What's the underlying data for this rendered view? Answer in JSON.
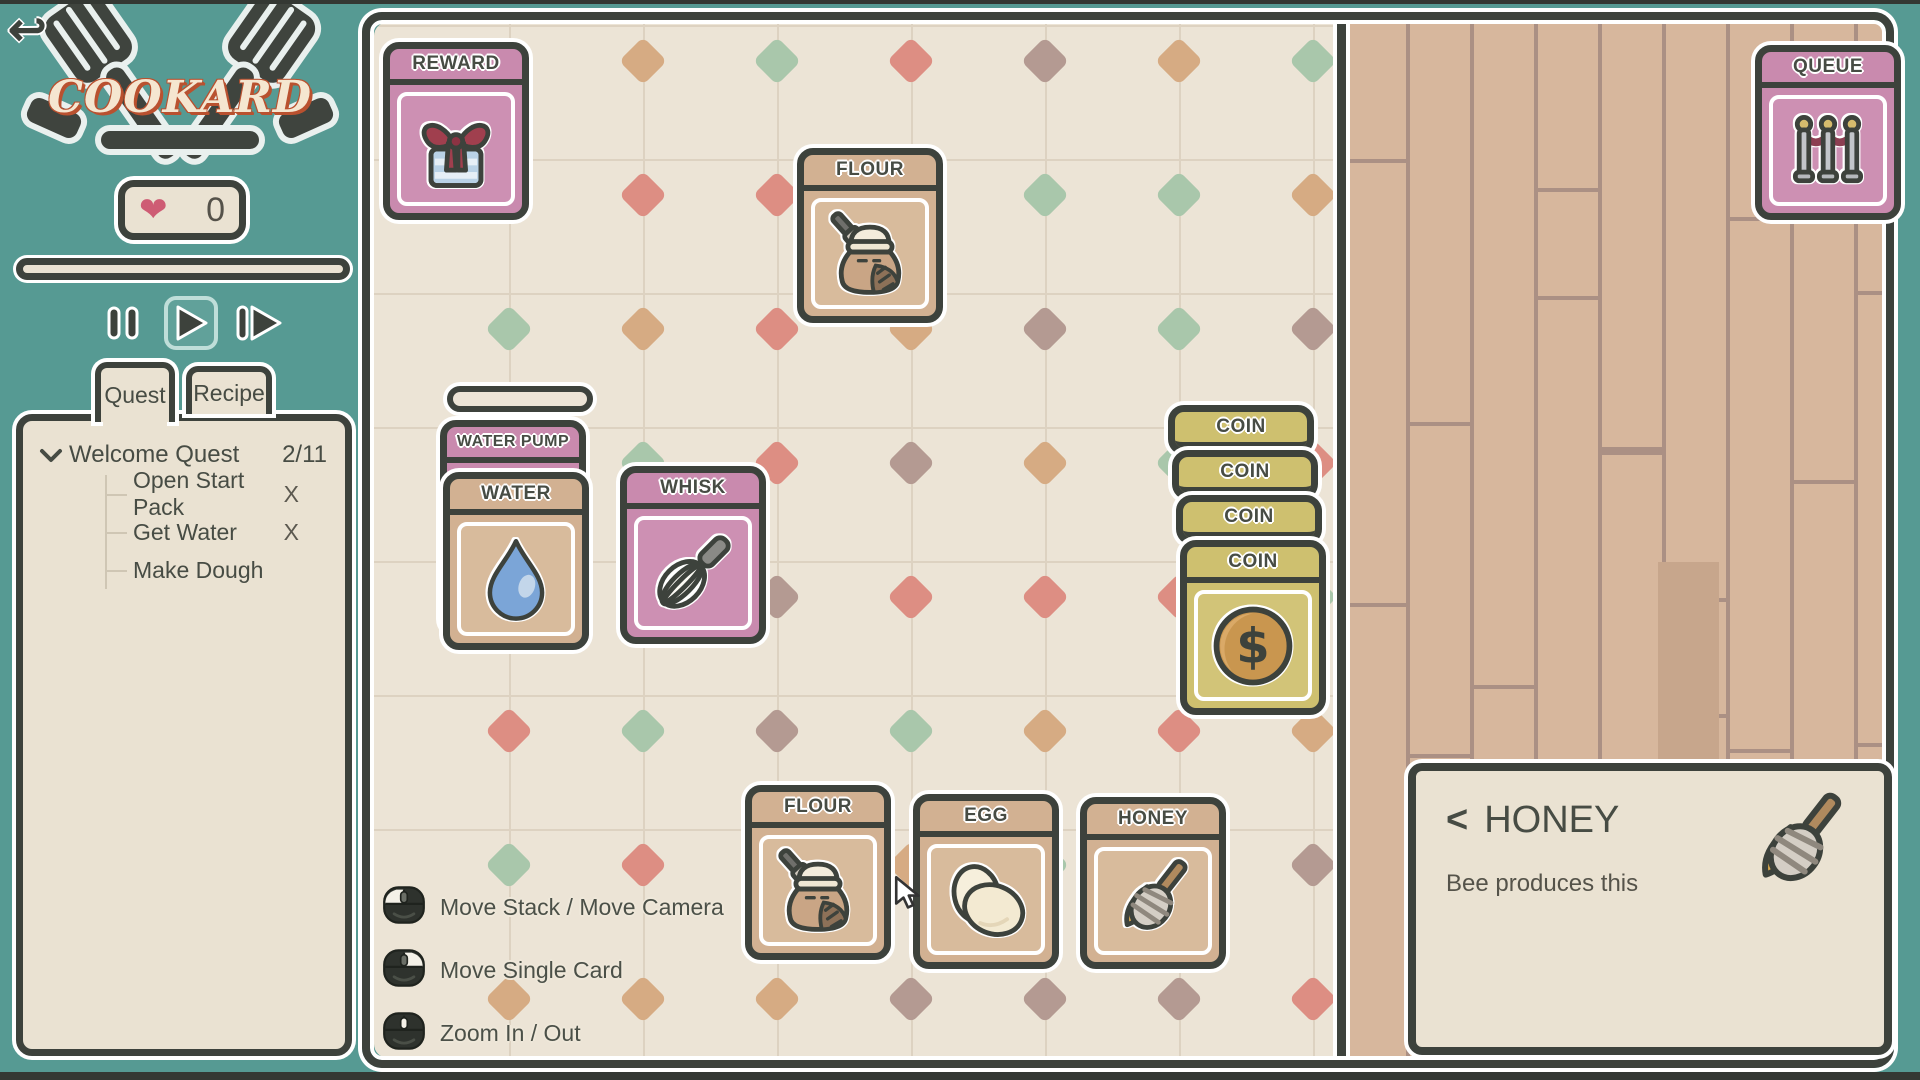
{
  "app": {
    "title": "COOKARD"
  },
  "hud": {
    "hearts_value": "0",
    "heart_icon": "heart-icon"
  },
  "controls": {
    "buttons": [
      {
        "name": "pause",
        "icon": "pause-icon",
        "active": false
      },
      {
        "name": "play",
        "icon": "play-icon",
        "active": true
      },
      {
        "name": "fast-forward",
        "icon": "fast-forward-icon",
        "active": false
      }
    ]
  },
  "tabs": [
    {
      "label": "Quest",
      "active": true
    },
    {
      "label": "Recipe",
      "active": false
    }
  ],
  "quest": {
    "title": "Welcome Quest",
    "progress": "2/11",
    "items": [
      {
        "label": "Open Start Pack",
        "status": "X"
      },
      {
        "label": "Get Water",
        "status": "X"
      },
      {
        "label": "Make Dough",
        "status": ""
      }
    ]
  },
  "board": {
    "cards": [
      {
        "label": "REWARD",
        "icon": "gift-icon",
        "variant": "pink",
        "x": 383,
        "y": 42,
        "h": 178
      },
      {
        "label": "FLOUR",
        "icon": "flour-sack-icon",
        "variant": "tan",
        "x": 797,
        "y": 148,
        "h": 175
      },
      {
        "label": "WATER PUMP",
        "icon": "",
        "variant": "pink",
        "x": 440,
        "y": 420,
        "h": 215,
        "small_title": true
      },
      {
        "label": "WATER",
        "icon": "water-drop-icon",
        "variant": "tan",
        "x": 443,
        "y": 472,
        "h": 178
      },
      {
        "label": "WHISK",
        "icon": "whisk-icon",
        "variant": "pink",
        "x": 620,
        "y": 466,
        "h": 178
      },
      {
        "label": "COIN",
        "icon": "",
        "variant": "coin",
        "x": 1168,
        "y": 405,
        "header_only": true
      },
      {
        "label": "COIN",
        "icon": "",
        "variant": "coin",
        "x": 1172,
        "y": 450,
        "header_only": true
      },
      {
        "label": "COIN",
        "icon": "",
        "variant": "coin",
        "x": 1176,
        "y": 495,
        "header_only": true
      },
      {
        "label": "COIN",
        "icon": "coin-icon",
        "variant": "coin",
        "x": 1180,
        "y": 540,
        "h": 175
      },
      {
        "label": "FLOUR",
        "icon": "flour-sack-icon",
        "variant": "tan",
        "x": 745,
        "y": 785,
        "h": 175
      },
      {
        "label": "EGG",
        "icon": "egg-icon",
        "variant": "tan",
        "x": 913,
        "y": 794,
        "h": 175
      },
      {
        "label": "HONEY",
        "icon": "honey-dipper-icon",
        "variant": "tan",
        "x": 1080,
        "y": 797,
        "h": 172
      },
      {
        "label": "QUEUE",
        "icon": "queue-stanchions-icon",
        "variant": "pink",
        "x": 1755,
        "y": 45,
        "h": 175
      }
    ]
  },
  "hints": [
    {
      "icon": "mouse-left-icon",
      "label": "Move Stack / Move Camera"
    },
    {
      "icon": "mouse-right-icon",
      "label": "Move Single Card"
    },
    {
      "icon": "mouse-wheel-icon",
      "label": "Zoom In / Out"
    }
  ],
  "info_panel": {
    "back_chevron": "<",
    "title": "HONEY",
    "description": "Bee produces this",
    "icon": "honey-dipper-icon"
  },
  "theme": {
    "teal": "#569a93",
    "dark": "#3d423c",
    "cream": "#eae2d2",
    "diamond_palette": [
      "#b49a92",
      "#dd8e83",
      "#a9c7ab",
      "#d6ab83"
    ],
    "wood": "#d7b79d",
    "wood_line": "#ab9084",
    "wood_dark_plank": "#c7a68c"
  }
}
